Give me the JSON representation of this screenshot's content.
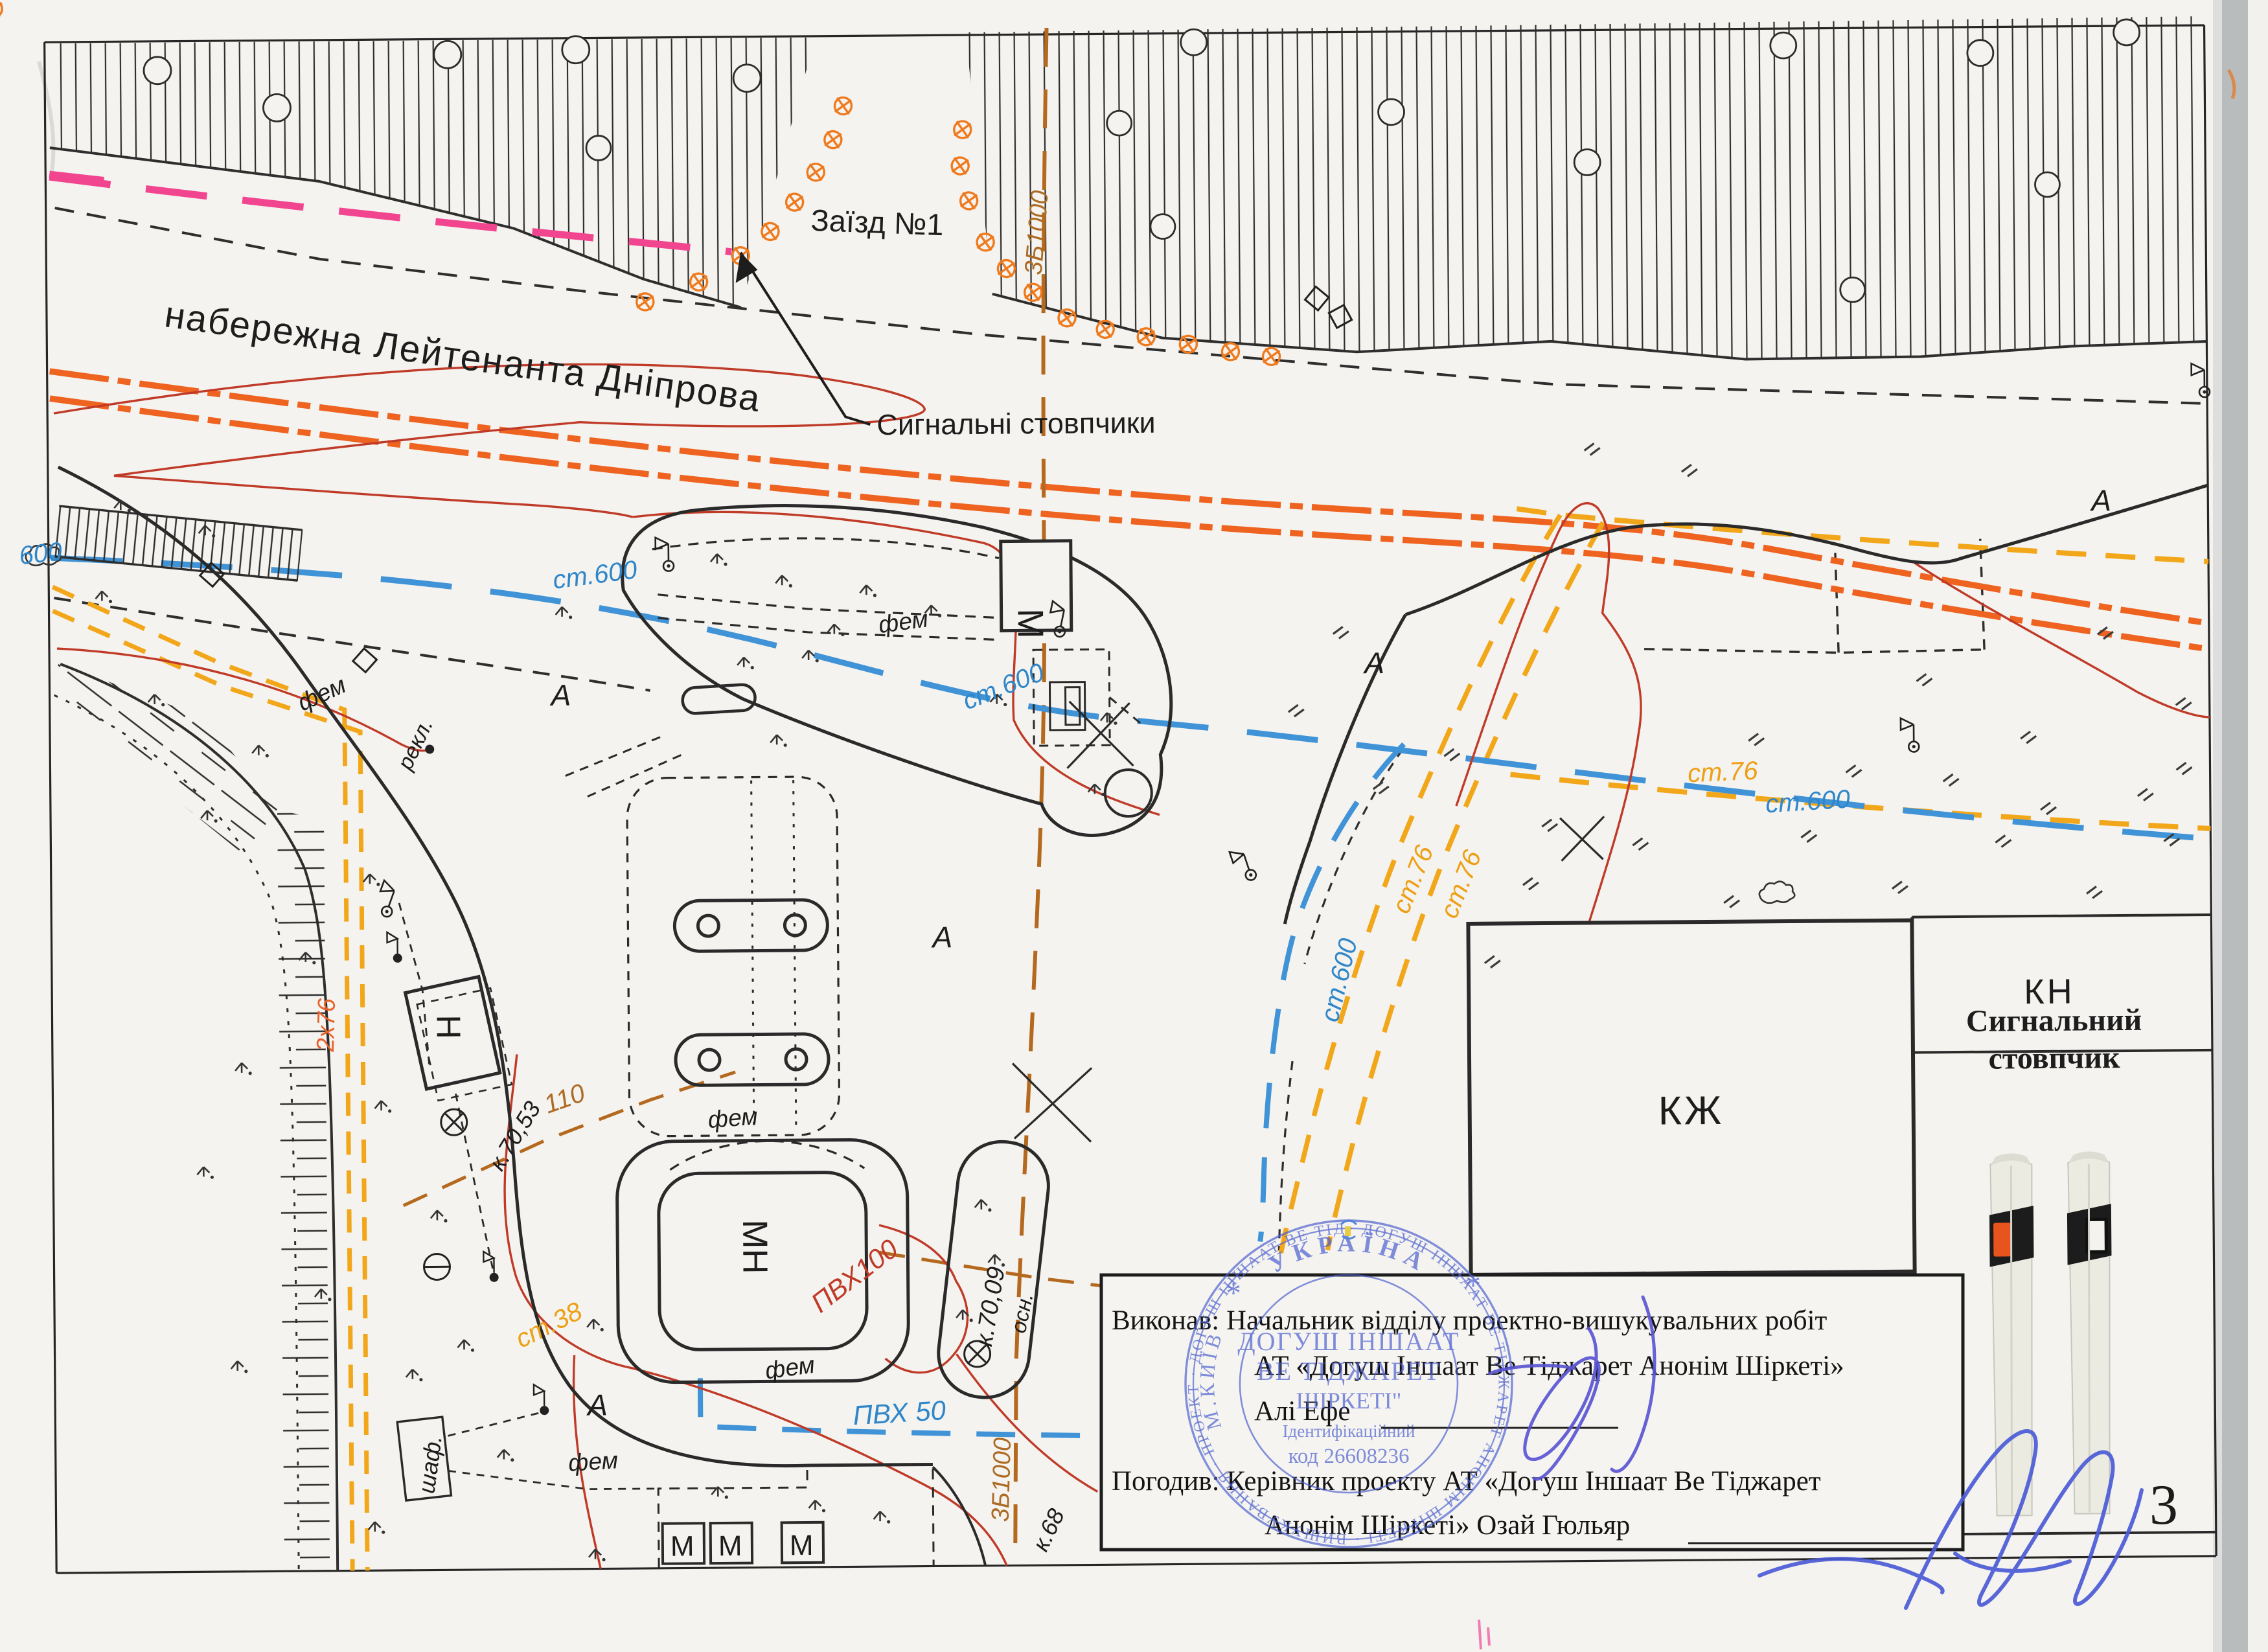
{
  "page_number": "3",
  "colors": {
    "paper": "#f4f3ef",
    "ink": "#1d1d1d",
    "utility_blue": "#2f86c9",
    "utility_yellow": "#eda015",
    "utility_orange": "#e8622a",
    "utility_brown": "#ad6b24",
    "red_line": "#c03a28",
    "pink_line": "#f2458f",
    "stamp_blue": "#4b5ecf",
    "signature_blue": "#5a55d2",
    "post_reflector_orange": "#e8541e"
  },
  "map": {
    "street": "набережна Лейтенанта Дніпрова",
    "driveway": "Заїзд №1",
    "callout": "Сигнальні стовпчики",
    "buildings": {
      "m": "М",
      "mn": "МН",
      "n": "Н",
      "kzh": "КЖ"
    },
    "kiosks": [
      "М",
      "М",
      "М"
    ],
    "legend": {
      "kn": "КН",
      "title1": "Сигнальний",
      "title2": "стовпчик"
    },
    "utilities": {
      "st600": "ст.600",
      "n600": "600",
      "st76": "ст.76",
      "st38": "ст.38",
      "pvc100": "ПВХ100",
      "pvc50": "ПВХ 50",
      "l110": "110",
      "c2x76": "2х76",
      "c3b1000": "3Б1000"
    },
    "marks": {
      "fem": "фем",
      "rekl": "рекл.",
      "shaf": "шаф.",
      "osn": "осн.",
      "k7009": "к.70,09",
      "k7053": "к.70,53",
      "k68": "к.68",
      "a": "А"
    }
  },
  "textbox": {
    "line1": "Виконав: Начальник відділу проектно-вишукувальних робіт",
    "line2": "АТ «Догуш Іншаат Ве Тіджарет Анонім Шіркеті»",
    "line3": "Алі Ефе",
    "line4": "Погодив: Керівник проекту АТ «Догуш Іншаат Ве Тіджарет",
    "line5": "Анонім Шіркеті» Озай Гюльяр"
  },
  "stamp": {
    "country": "УКРАЇНА",
    "city": "М.КИЇВ",
    "org1": "ДОГУШ ІНШААТ",
    "org2": "ВЕ ТІДЖАРЕТ",
    "org3": "ШІРКЕТІ\"",
    "id1": "Ідентифікаційний",
    "id2": "код 26608236",
    "ring": "· ДОГУШ ІНШААТ ВЕ ТІДЖАРЕТ АНОНІМ ШІРКЕТІ · ВИШУКУВАННЯ · ПРОЕКТ · ДОГУШ ІНШААТ ВЕ ТІДЖАРЕТ ·",
    "star": "*"
  }
}
